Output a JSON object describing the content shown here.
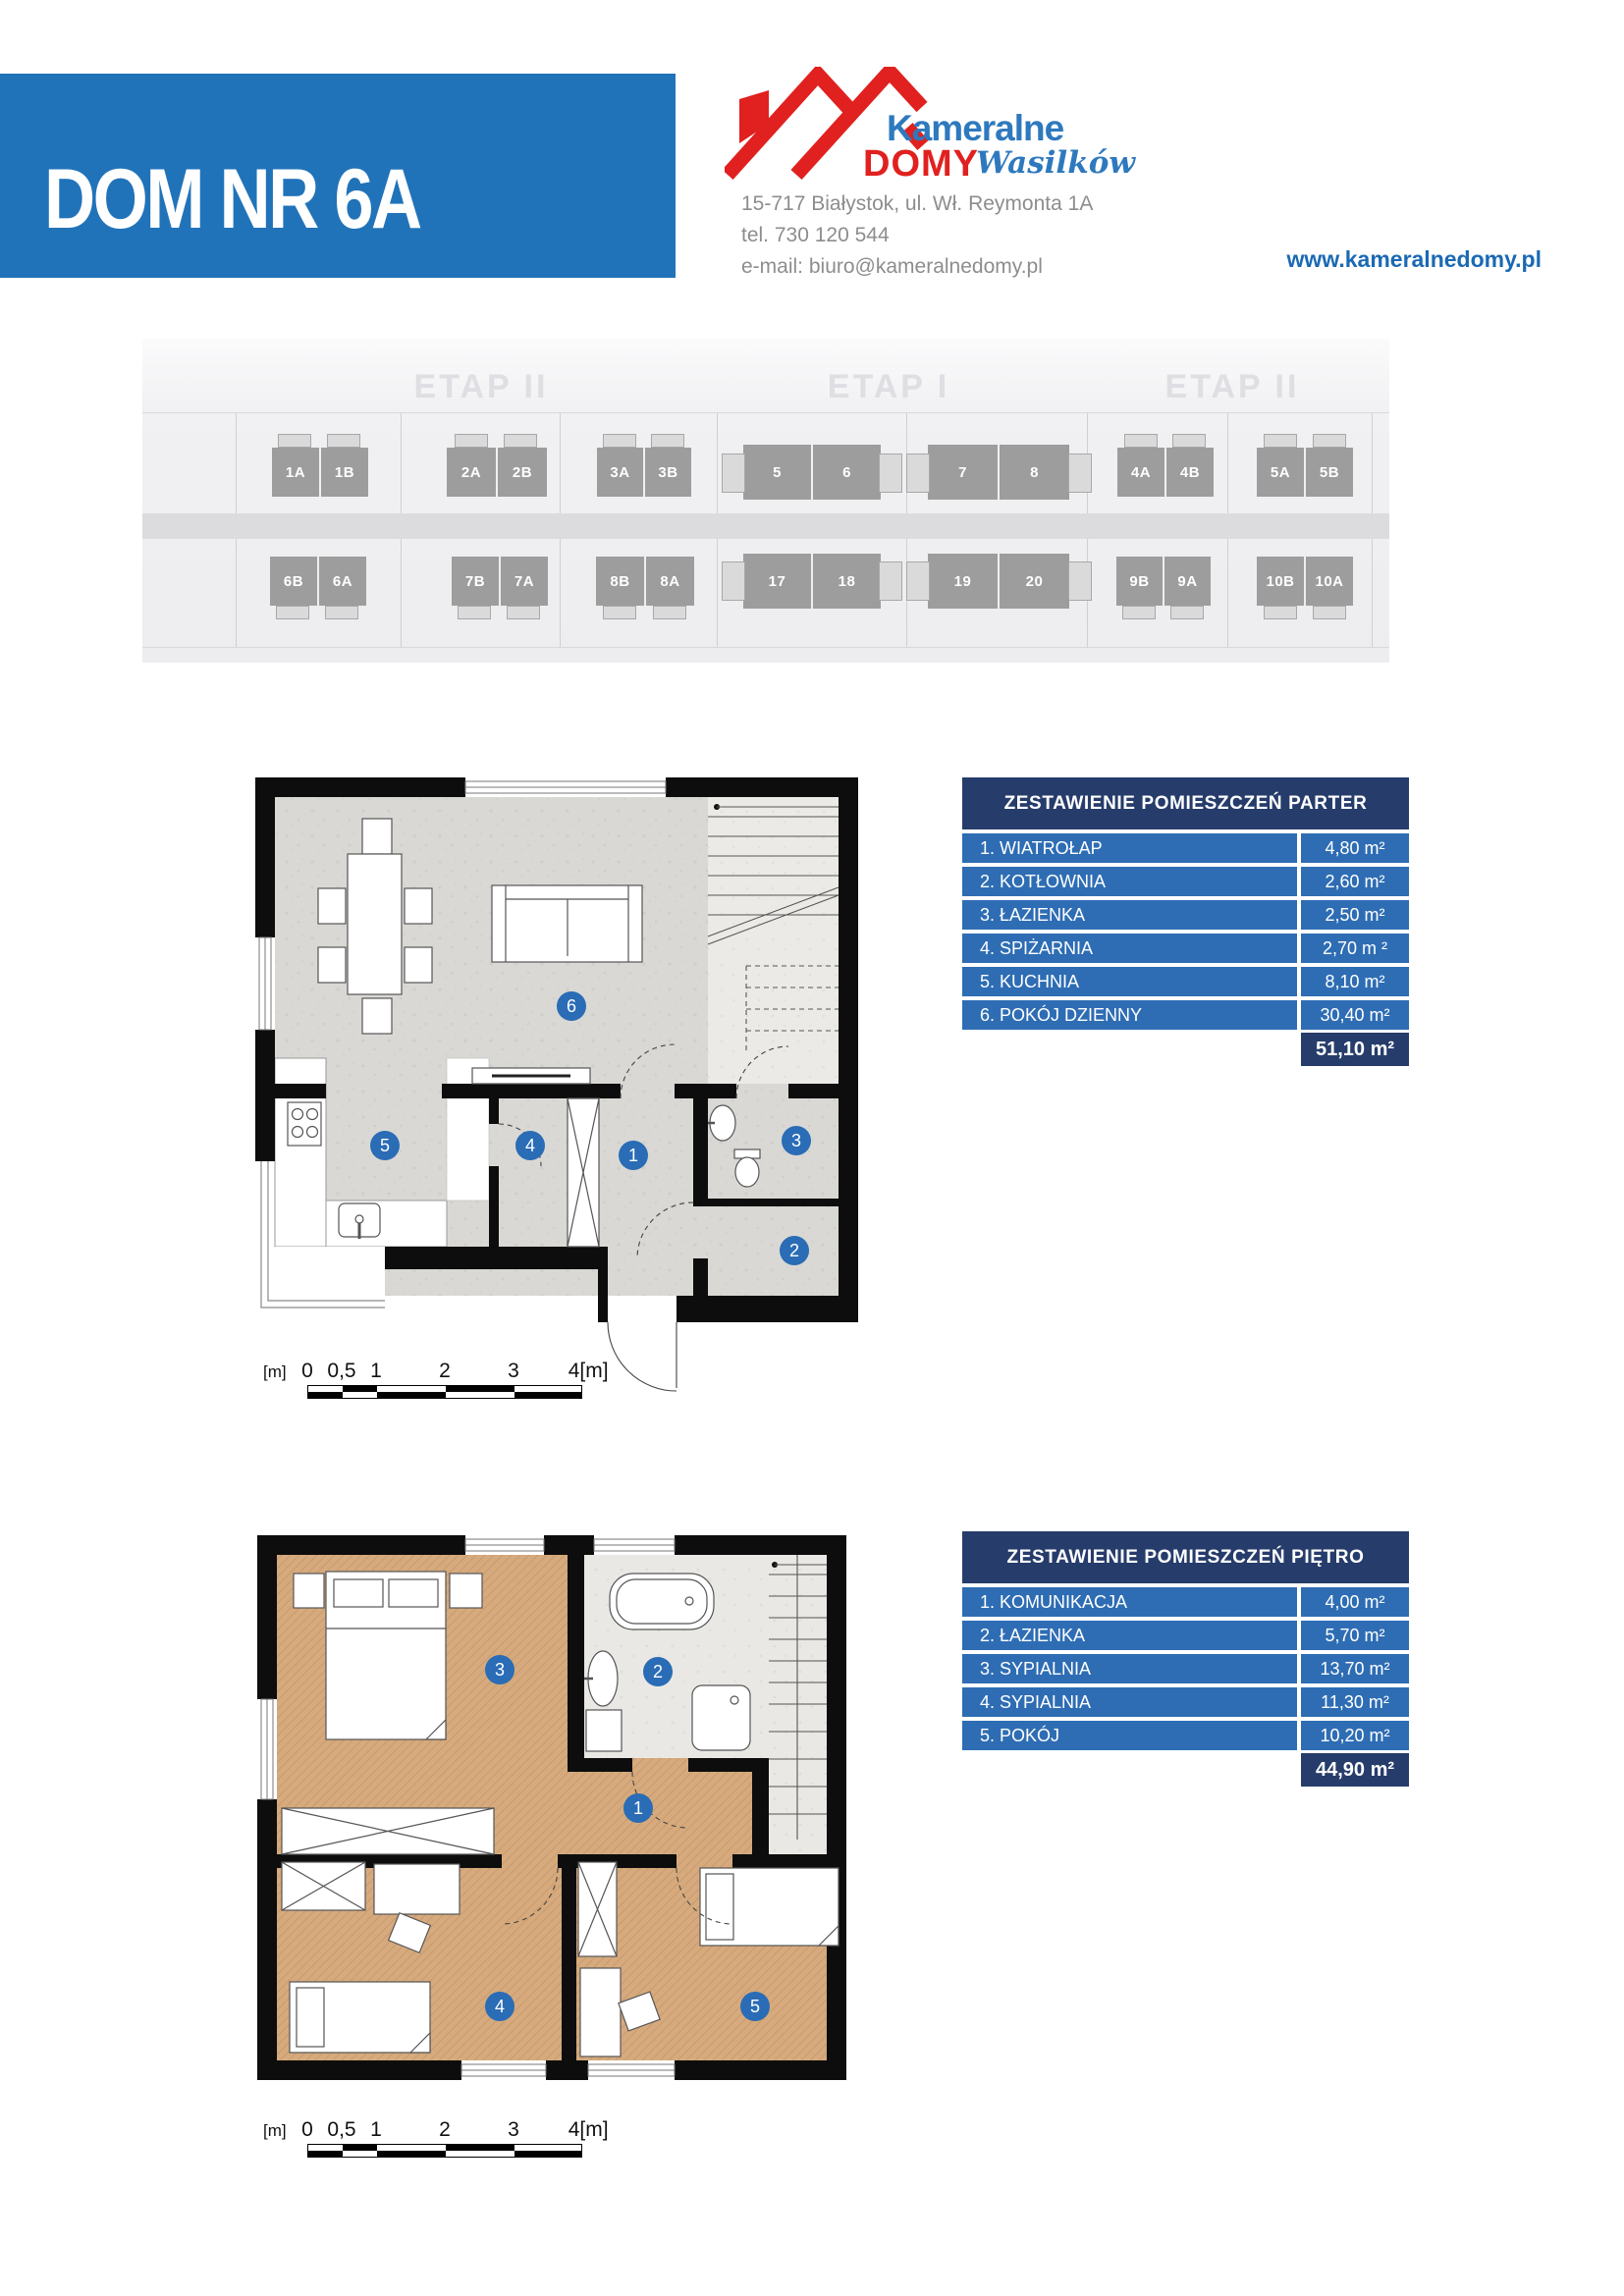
{
  "header": {
    "title": "DOM NR 6A",
    "logo": {
      "brand_top": "Kameralne",
      "brand_bottom": "DOMY",
      "brand_script": "Wasilków"
    },
    "contact": {
      "address": "15-717 Białystok, ul. Wł. Reymonta 1A",
      "phone": "tel. 730 120 544",
      "email": "e-mail: biuro@kameralnedomy.pl"
    },
    "website": "www.kameralnedomy.pl"
  },
  "colors": {
    "banner_blue": "#2173b9",
    "table_header_navy": "#263c6b",
    "table_row_blue": "#2e6db4",
    "marker_blue": "#2a6cb5",
    "logo_red": "#e0211f",
    "logo_blue": "#2e79be",
    "wood_floor": "#d6aa7d",
    "concrete_floor": "#d9d8d4"
  },
  "site_plan": {
    "stage_labels": [
      "ETAP II",
      "ETAP I",
      "ETAP II"
    ],
    "row1": [
      [
        "1A",
        "1B"
      ],
      [
        "2A",
        "2B"
      ],
      [
        "3A",
        "3B"
      ],
      [
        "5",
        "6"
      ],
      [
        "7",
        "8"
      ],
      [
        "4A",
        "4B"
      ],
      [
        "5A",
        "5B"
      ]
    ],
    "row2": [
      [
        "6B",
        "6A"
      ],
      [
        "7B",
        "7A"
      ],
      [
        "8B",
        "8A"
      ],
      [
        "17",
        "18"
      ],
      [
        "19",
        "20"
      ],
      [
        "9B",
        "9A"
      ],
      [
        "10B",
        "10A"
      ]
    ]
  },
  "tables": {
    "parter": {
      "title": "ZESTAWIENIE POMIESZCZEŃ PARTER",
      "rows": [
        {
          "label": "1. WIATROŁAP",
          "area": "4,80 m²"
        },
        {
          "label": "2. KOTŁOWNIA",
          "area": "2,60 m²"
        },
        {
          "label": "3. ŁAZIENKA",
          "area": "2,50 m²"
        },
        {
          "label": "4. SPIŻARNIA",
          "area": "2,70 m ²"
        },
        {
          "label": "5. KUCHNIA",
          "area": "8,10 m²"
        },
        {
          "label": "6. POKÓJ DZIENNY",
          "area": "30,40 m²"
        }
      ],
      "total": "51,10 m²"
    },
    "pietro": {
      "title": "ZESTAWIENIE POMIESZCZEŃ PIĘTRO",
      "rows": [
        {
          "label": "1. KOMUNIKACJA",
          "area": "4,00 m²"
        },
        {
          "label": "2. ŁAZIENKA",
          "area": "5,70 m²"
        },
        {
          "label": "3. SYPIALNIA",
          "area": "13,70 m²"
        },
        {
          "label": "4. SYPIALNIA",
          "area": "11,30 m²"
        },
        {
          "label": "5. POKÓJ",
          "area": "10,20 m²"
        }
      ],
      "total": "44,90 m²"
    }
  },
  "plans": {
    "parter": {
      "markers": [
        "1",
        "2",
        "3",
        "4",
        "5",
        "6"
      ]
    },
    "pietro": {
      "markers": [
        "1",
        "2",
        "3",
        "4",
        "5"
      ]
    }
  },
  "scale_bar": {
    "unit": "[m]",
    "labels": [
      "0",
      "0,5",
      "1",
      "2",
      "3"
    ],
    "end_label": "4[m]"
  }
}
